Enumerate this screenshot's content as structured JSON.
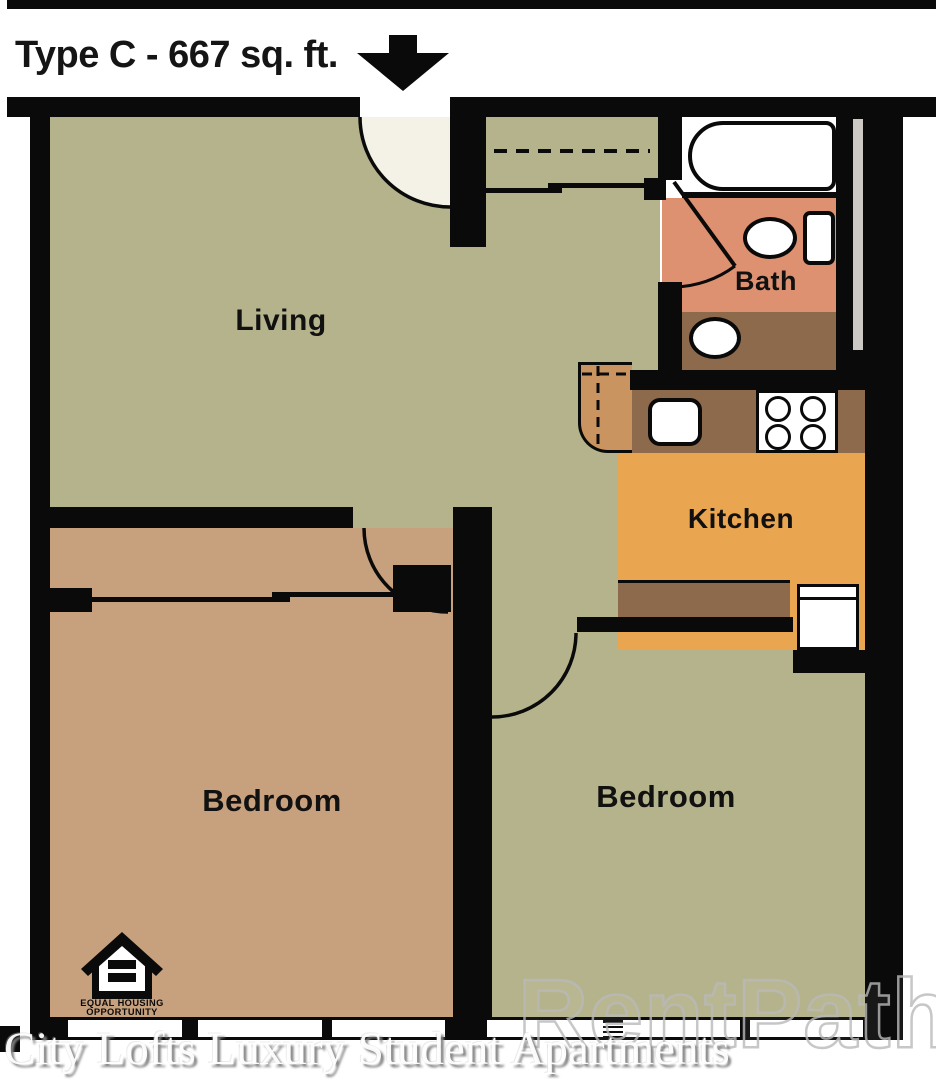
{
  "title": "Type C - 667 sq. ft.",
  "rooms": {
    "living": "Living",
    "bath": "Bath",
    "kitchen": "Kitchen",
    "bedroom_left": "Bedroom",
    "bedroom_right": "Bedroom"
  },
  "logo": {
    "line1": "EQUAL HOUSING",
    "line2": "OPPORTUNITY"
  },
  "caption": "City Lofts Luxury Student Apartments",
  "watermark": {
    "text": "RentPath",
    "reg": "®"
  },
  "colors": {
    "wall": "#0a0a0a",
    "floor_green": "#b4b38b",
    "floor_tan": "#c7a17e",
    "bath_salmon": "#de9170",
    "counter_brown": "#8e6a4c",
    "kitchen_orange": "#e9a550",
    "peninsula": "#ca9461",
    "chase_gray": "#ccc8c4",
    "title_text": "#151515"
  }
}
